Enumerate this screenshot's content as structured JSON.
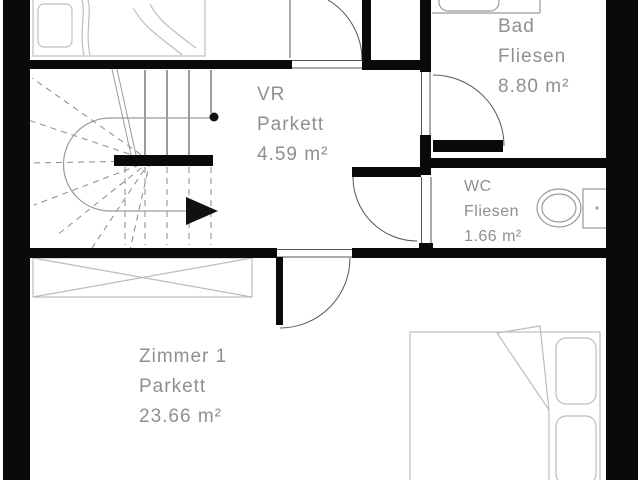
{
  "plan_title": "Apartment floor plan",
  "colors": {
    "wall": "#0a0a0a",
    "label_text": "#8f8f8f",
    "furniture_line": "#bdbdbd",
    "door_arc": "#555555",
    "stair_dashed": "#8a8a8a"
  },
  "rooms": [
    {
      "id": "vr",
      "name": "VR",
      "floor": "Parkett",
      "area": "4.59 m²"
    },
    {
      "id": "bad",
      "name": "Bad",
      "floor": "Fliesen",
      "area": "8.80 m²"
    },
    {
      "id": "wc",
      "name": "WC",
      "floor": "Fliesen",
      "area": "1.66 m²"
    },
    {
      "id": "zimmer1",
      "name": "Zimmer 1",
      "floor": "Parkett",
      "area": "23.66 m²"
    }
  ]
}
